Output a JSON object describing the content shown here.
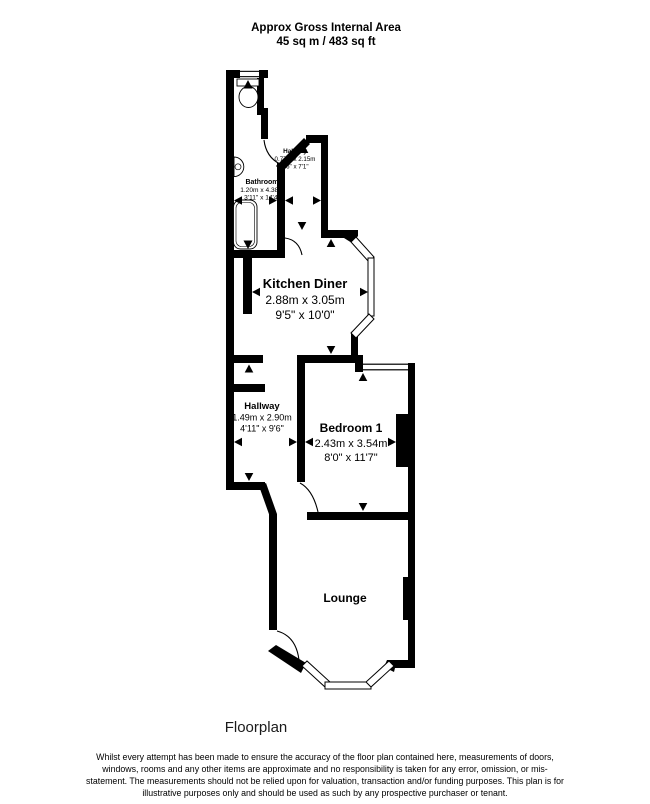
{
  "title": {
    "line1": "Approx Gross Internal Area",
    "line2": "45 sq m / 483 sq ft"
  },
  "rooms": {
    "entry_hallway": {
      "name": "Hallway",
      "metric": "0.77m x 2.15m",
      "imperial": "2'6\" x 7'1\""
    },
    "bathroom": {
      "name": "Bathroom",
      "metric": "1.20m x 4.38m",
      "imperial": "3'11\" x 14'4\""
    },
    "kitchen_diner": {
      "name": "Kitchen Diner",
      "metric": "2.88m x 3.05m",
      "imperial": "9'5\" x 10'0\""
    },
    "hallway": {
      "name": "Hallway",
      "metric": "1.49m x 2.90m",
      "imperial": "4'11\" x 9'6\""
    },
    "bedroom_1": {
      "name": "Bedroom 1",
      "metric": "2.43m x 3.54m",
      "imperial": "8'0\" x 11'7\""
    },
    "lounge": {
      "name": "Lounge"
    }
  },
  "caption": "Floorplan",
  "disclaimer": "Whilst every attempt has been made to ensure the accuracy of the floor plan contained here, measurements of doors, windows, rooms and any other items are approximate and no responsibility is taken for any error, omission, or mis-statement. The measurements should not be relied upon for valuation, transaction and/or funding purposes. This plan is for illustrative purposes only and should be used as such by any prospective purchaser or tenant.",
  "colors": {
    "wall": "#000000",
    "background": "#ffffff",
    "text": "#000000"
  }
}
